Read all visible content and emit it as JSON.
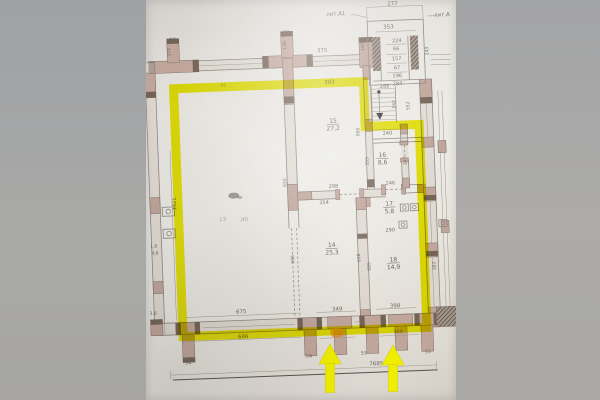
{
  "plan": {
    "highlight": {
      "color": "#f0ee00"
    },
    "building_labels": [
      {
        "t": "лит.А1",
        "x": 197,
        "y": 21
      },
      {
        "t": "лит.А",
        "x": 303,
        "y": 26
      }
    ],
    "rooms": [
      {
        "number": "15",
        "area": "27,2",
        "x": 190,
        "y": 128
      },
      {
        "number": "16",
        "area": "8,6",
        "x": 238,
        "y": 164
      },
      {
        "number": "17",
        "area": "5,8",
        "x": 243,
        "y": 213
      },
      {
        "number": "14",
        "area": "25,3",
        "x": 184,
        "y": 252
      },
      {
        "number": "18",
        "area": "14,9",
        "x": 245,
        "y": 269
      }
    ],
    "labels": [
      {
        "t": "277",
        "x": 254,
        "y": 13
      },
      {
        "t": "353",
        "x": 249,
        "y": 36
      },
      {
        "t": "52",
        "x": 33,
        "y": 41
      },
      {
        "t": "51",
        "x": 147,
        "y": 38
      },
      {
        "t": "375",
        "x": 182,
        "y": 57
      },
      {
        "t": "41",
        "x": 82,
        "y": 88,
        "s": 5,
        "cls": "faint"
      },
      {
        "t": "393",
        "x": 188,
        "y": 89
      },
      {
        "t": "160",
        "x": 224,
        "y": 53,
        "r": -90,
        "s": 4.5
      },
      {
        "t": "172",
        "x": 30,
        "y": 51,
        "r": -90,
        "s": 4.5
      },
      {
        "t": "130",
        "x": 146,
        "y": 49,
        "r": -90,
        "s": 4.5
      },
      {
        "t": "224",
        "x": 257,
        "y": 50,
        "s": 5
      },
      {
        "t": "66",
        "x": 256,
        "y": 58,
        "s": 5
      },
      {
        "t": "157",
        "x": 256,
        "y": 68,
        "s": 5
      },
      {
        "t": "67",
        "x": 256,
        "y": 77,
        "s": 5
      },
      {
        "t": "196",
        "x": 256,
        "y": 85,
        "s": 5
      },
      {
        "t": "284",
        "x": 256,
        "y": 93,
        "s": 5
      },
      {
        "t": "243",
        "x": 288,
        "y": 60,
        "r": -90,
        "s": 4.5
      },
      {
        "t": "286",
        "x": 243,
        "y": 95,
        "s": 5
      },
      {
        "t": "242",
        "x": 253,
        "y": 112,
        "r": -90,
        "s": 4.5
      },
      {
        "t": "552",
        "x": 267,
        "y": 114,
        "r": -90,
        "s": 4.5
      },
      {
        "t": "240",
        "x": 244,
        "y": 142,
        "s": 5
      },
      {
        "t": "695",
        "x": 216,
        "y": 138,
        "r": -90,
        "s": 4.5
      },
      {
        "t": "353",
        "x": 224,
        "y": 168,
        "r": -90,
        "s": 4.5
      },
      {
        "t": "347",
        "x": 262,
        "y": 169,
        "r": -90,
        "s": 4.5
      },
      {
        "t": "246",
        "x": 245,
        "y": 192,
        "s": 5
      },
      {
        "t": "298",
        "x": 188,
        "y": 193,
        "s": 5
      },
      {
        "t": "354",
        "x": 178,
        "y": 209,
        "s": 5
      },
      {
        "t": "620",
        "x": 141,
        "y": 186,
        "r": -90,
        "s": 4.5
      },
      {
        "t": "290",
        "x": 243,
        "y": 239,
        "s": 5
      },
      {
        "t": "1421",
        "x": 30,
        "y": 203,
        "r": -90,
        "s": 5
      },
      {
        "t": "13",
        "x": 76,
        "y": 222,
        "cls": "faint",
        "s": 5.5
      },
      {
        "t": ",90",
        "x": 97,
        "y": 223,
        "cls": "faint",
        "s": 5.5
      },
      {
        "t": "695",
        "x": 146,
        "y": 263,
        "r": -90,
        "s": 4.5
      },
      {
        "t": "618",
        "x": 212,
        "y": 264,
        "r": -90,
        "s": 4.5
      },
      {
        "t": "685",
        "x": 222,
        "y": 273,
        "r": -90,
        "s": 4.5
      },
      {
        "t": "383",
        "x": 287,
        "y": 275,
        "r": -90,
        "s": 4.5
      },
      {
        "t": "675",
        "x": 91,
        "y": 315
      },
      {
        "t": "686",
        "x": 92,
        "y": 340
      },
      {
        "t": "349",
        "x": 187,
        "y": 316
      },
      {
        "t": "398",
        "x": 245,
        "y": 315
      },
      {
        "t": "216",
        "x": 186,
        "y": 342,
        "s": 5
      },
      {
        "t": "369",
        "x": 247,
        "y": 341,
        "s": 5
      },
      {
        "t": "54",
        "x": 36,
        "y": 364,
        "s": 5,
        "name": "column-label"
      },
      {
        "t": "54",
        "x": 157,
        "y": 362,
        "s": 5,
        "name": "column-label"
      },
      {
        "t": "55",
        "x": 212,
        "y": 361,
        "s": 5,
        "name": "column-label"
      },
      {
        "t": "55",
        "x": 276,
        "y": 362,
        "s": 5,
        "name": "column-label"
      },
      {
        "t": "7685",
        "x": 224,
        "y": 372
      },
      {
        "t": "59",
        "x": 7,
        "y": 321,
        "s": 4.5
      },
      {
        "t": "1,8",
        "x": 6,
        "y": 246,
        "s": 4.5
      },
      {
        "t": "4,6",
        "x": 7,
        "y": 253,
        "s": 4.5
      },
      {
        "t": "3,6",
        "x": 3,
        "y": 313,
        "s": 4.5
      }
    ],
    "arrows": [
      {
        "x": 184,
        "tip": 344,
        "stem": 29
      },
      {
        "x": 247,
        "tip": 345,
        "stem": 27
      }
    ]
  }
}
